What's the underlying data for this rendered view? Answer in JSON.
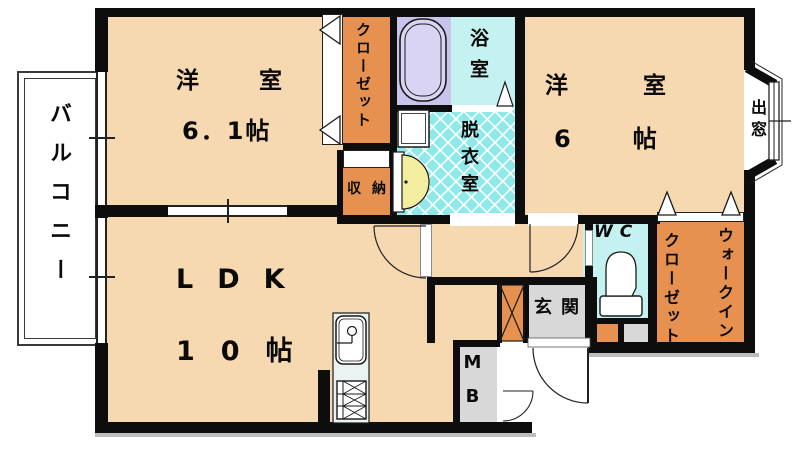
{
  "title": "apartment-floor-plan",
  "floor_plan": {
    "balcony": {
      "label": "バルコニー"
    },
    "bedroom1": {
      "label": "洋室",
      "size": "6．1帖"
    },
    "bedroom2": {
      "label": "洋室",
      "size": "6帖"
    },
    "ldk": {
      "label": "LDK",
      "size": "10帖"
    },
    "closet": {
      "label": "クローゼット"
    },
    "storage": {
      "label": "収納"
    },
    "bathroom": {
      "label": "浴室"
    },
    "dressing_room": {
      "label": "脱衣室"
    },
    "bay_window": {
      "label": "出窓"
    },
    "toilet": {
      "label": "WC"
    },
    "walk_in_closet": {
      "label_line1": "ウォークイン",
      "label_line2": "クローゼット"
    },
    "entrance": {
      "label": "玄関"
    },
    "meter_box": {
      "label": "MB"
    }
  },
  "colors": {
    "room_fill": "#f6d8b1",
    "closet_fill": "#e69150",
    "bath_fill": "#c4f2f0",
    "dressing_fill": "#8fe9e9",
    "bathtub_area_fill": "#c9c4ec",
    "entrance_fill": "#d8d8d8",
    "basin_fill": "#f3eda0",
    "wall": "#0d0d0d"
  },
  "icons": {
    "bathtub": "bathtub-icon",
    "toilet": "toilet-icon",
    "kitchen_sink": "kitchen-sink-icon",
    "stove": "stove-icon",
    "washbasin": "washbasin-icon",
    "washer_pan": "washer-pan-icon",
    "door_swing": "door-swing-arc",
    "folding_door": "folding-door-triangle"
  }
}
